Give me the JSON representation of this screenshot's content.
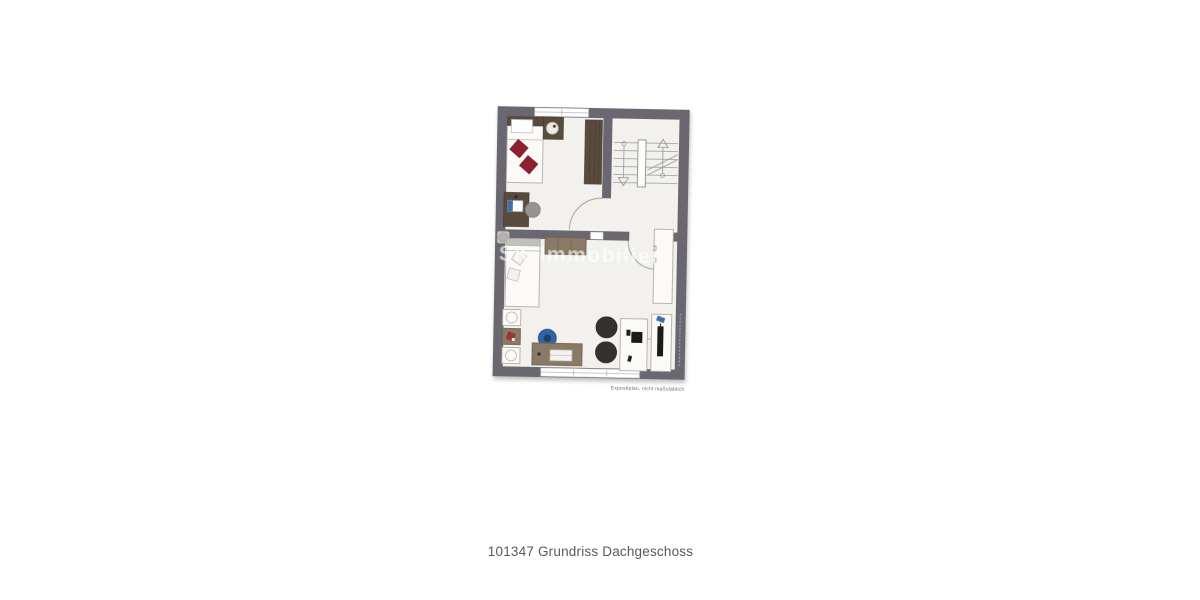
{
  "caption": "101347 Grundriss Dachgeschoss",
  "plan": {
    "watermark": "SK-Immobilien",
    "disclaimer": "Exposéplan, nicht maßstäblich",
    "colors": {
      "wall": "#6a6770",
      "floor": "#f2f1ee",
      "wood": "#8a7964",
      "wood_dark": "#594c3f",
      "red": "#8e2130",
      "blue": "#2f64a5",
      "blue_dark": "#1d4066",
      "dark": "#343231",
      "white_furn": "#fbfaf7",
      "outline": "#b0aea9"
    }
  }
}
